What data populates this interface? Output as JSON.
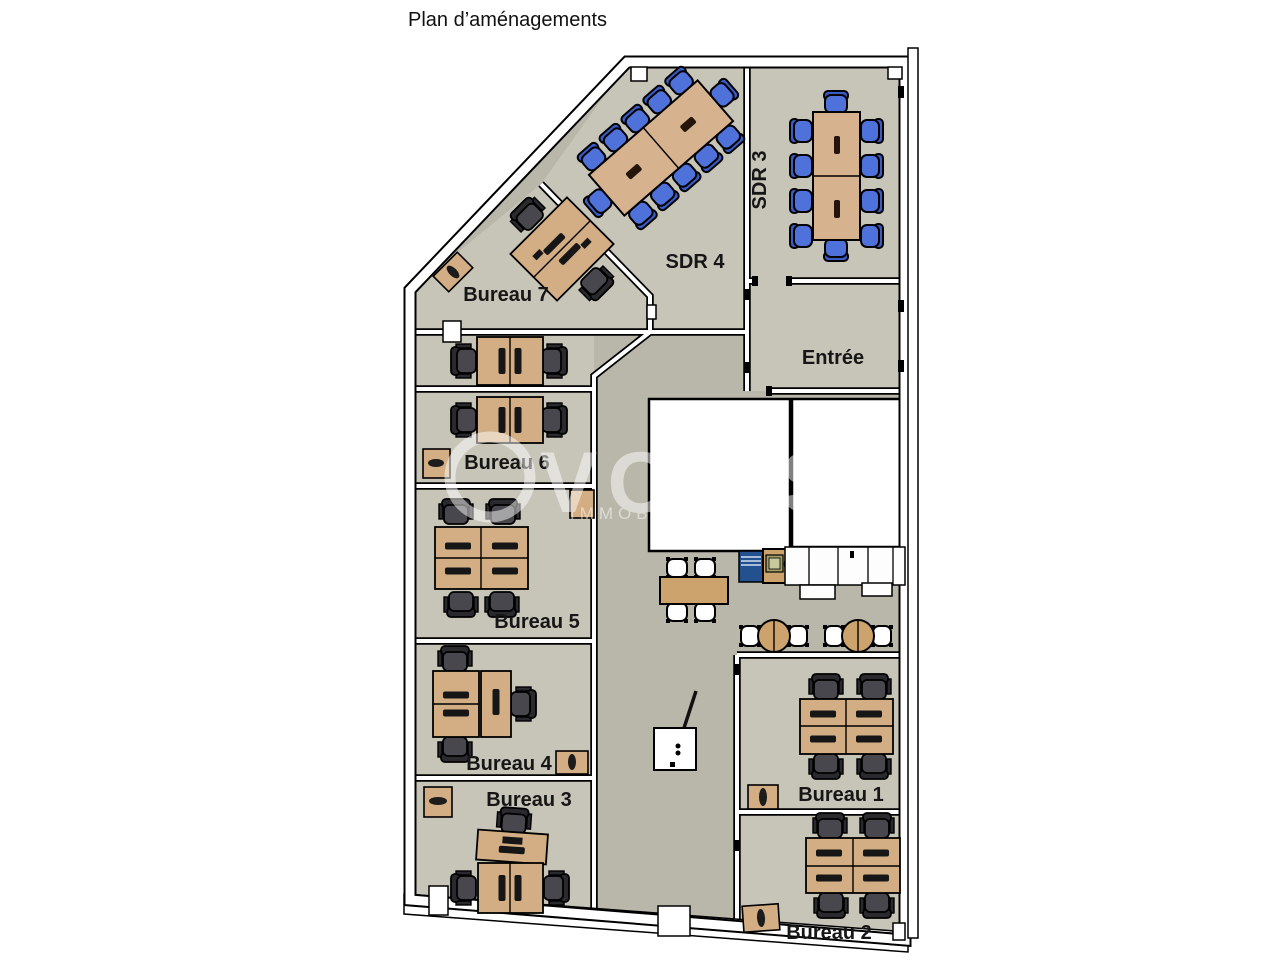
{
  "title": "Plan d’aménagements",
  "watermark": {
    "logo_text": "VOLIS",
    "subtext": "IMMOBIL"
  },
  "rooms": [
    {
      "id": "sdr4",
      "label": "SDR 4",
      "furniture": "diagonal conference table, 12 blue chairs"
    },
    {
      "id": "sdr3",
      "label": "SDR 3",
      "furniture": "vertical conference table, 10 blue chairs"
    },
    {
      "id": "entree",
      "label": "Entrée",
      "furniture": "empty entrance room"
    },
    {
      "id": "bureau7",
      "label": "Bureau 7",
      "furniture": "diagonal double desk, 2 chairs, side cabinet"
    },
    {
      "id": "bureau6",
      "label": "Bureau 6",
      "furniture": "double desk, 2 chairs, cabinet"
    },
    {
      "id": "bureau5",
      "label": "Bureau 5",
      "furniture": "4-desk cluster, 4 chairs, cabinet"
    },
    {
      "id": "bureau4",
      "label": "Bureau 4",
      "furniture": "L-shaped desks, 3 chairs, cabinet"
    },
    {
      "id": "bureau3",
      "label": "Bureau 3",
      "furniture": "T-shaped desks, 3 chairs, cabinet"
    },
    {
      "id": "bureau1",
      "label": "Bureau 1",
      "furniture": "4-desk cluster, 4 chairs, cabinet"
    },
    {
      "id": "bureau2",
      "label": "Bureau 2",
      "furniture": "4-desk cluster, 4 chairs, cabinet"
    }
  ],
  "break_area": {
    "tables": "1 rectangular table with 4 white chairs, 2 round tables with 2 white chairs each",
    "kitchenette": "blue appliance, hob, sink, white cabinet run",
    "whiteboard": "flip chart on stand"
  },
  "colors": {
    "floor_corridor": "#b9b6aa",
    "floor_room": "#c7c4b8",
    "wall_fill": "#ffffff",
    "outline": "#000000",
    "desk": "#d3ad83",
    "conference_table": "#d6b38e",
    "table": "#cda36d",
    "chair_blue": "#4f71da",
    "chair_blue_dark": "#3a5cc6",
    "chair_gray": "#47474d",
    "chair_gray_dark": "#29292e",
    "appliance_blue": "#23518f"
  }
}
